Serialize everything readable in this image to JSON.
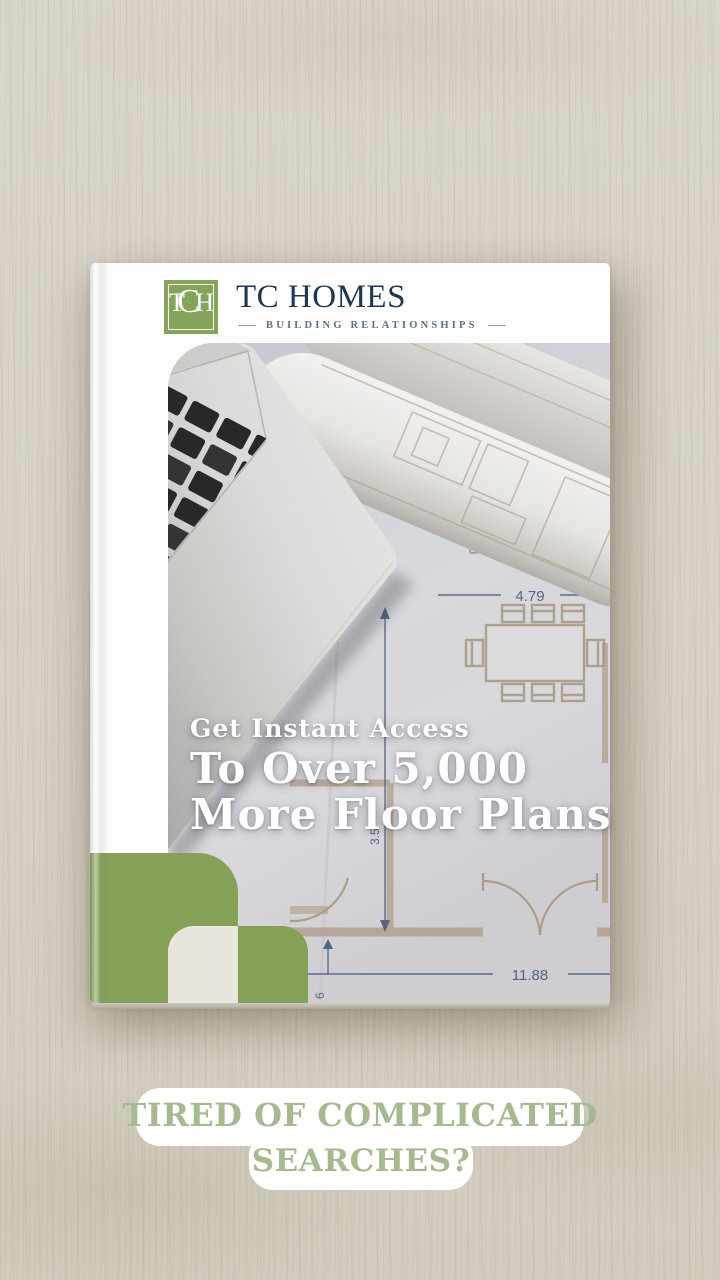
{
  "background": {
    "wood_color": "#d8d3c6"
  },
  "book": {
    "header": {
      "monogram_letters": {
        "t": "T",
        "c": "C",
        "h": "H"
      },
      "brand": "TC HOMES",
      "tagline": "BUILDING RELATIONSHIPS"
    },
    "title": {
      "line1": "Get Instant Access",
      "line2": "To Over 5,000",
      "line3": "More Floor Plans"
    },
    "floor_plan": {
      "top_dimension": "4.79",
      "bottom_dimension": "11.88",
      "side_dimension": "3.5",
      "edge_dimension": "6"
    },
    "colors": {
      "brand_green": "#86a35b",
      "cover_green": "#84a157",
      "cream": "#e9e7dd",
      "navy": "#1e3850"
    }
  },
  "banner": {
    "line1": "TIRED OF COMPLICATED",
    "line2": "SEARCHES?",
    "text_color": "#a5ba90"
  }
}
